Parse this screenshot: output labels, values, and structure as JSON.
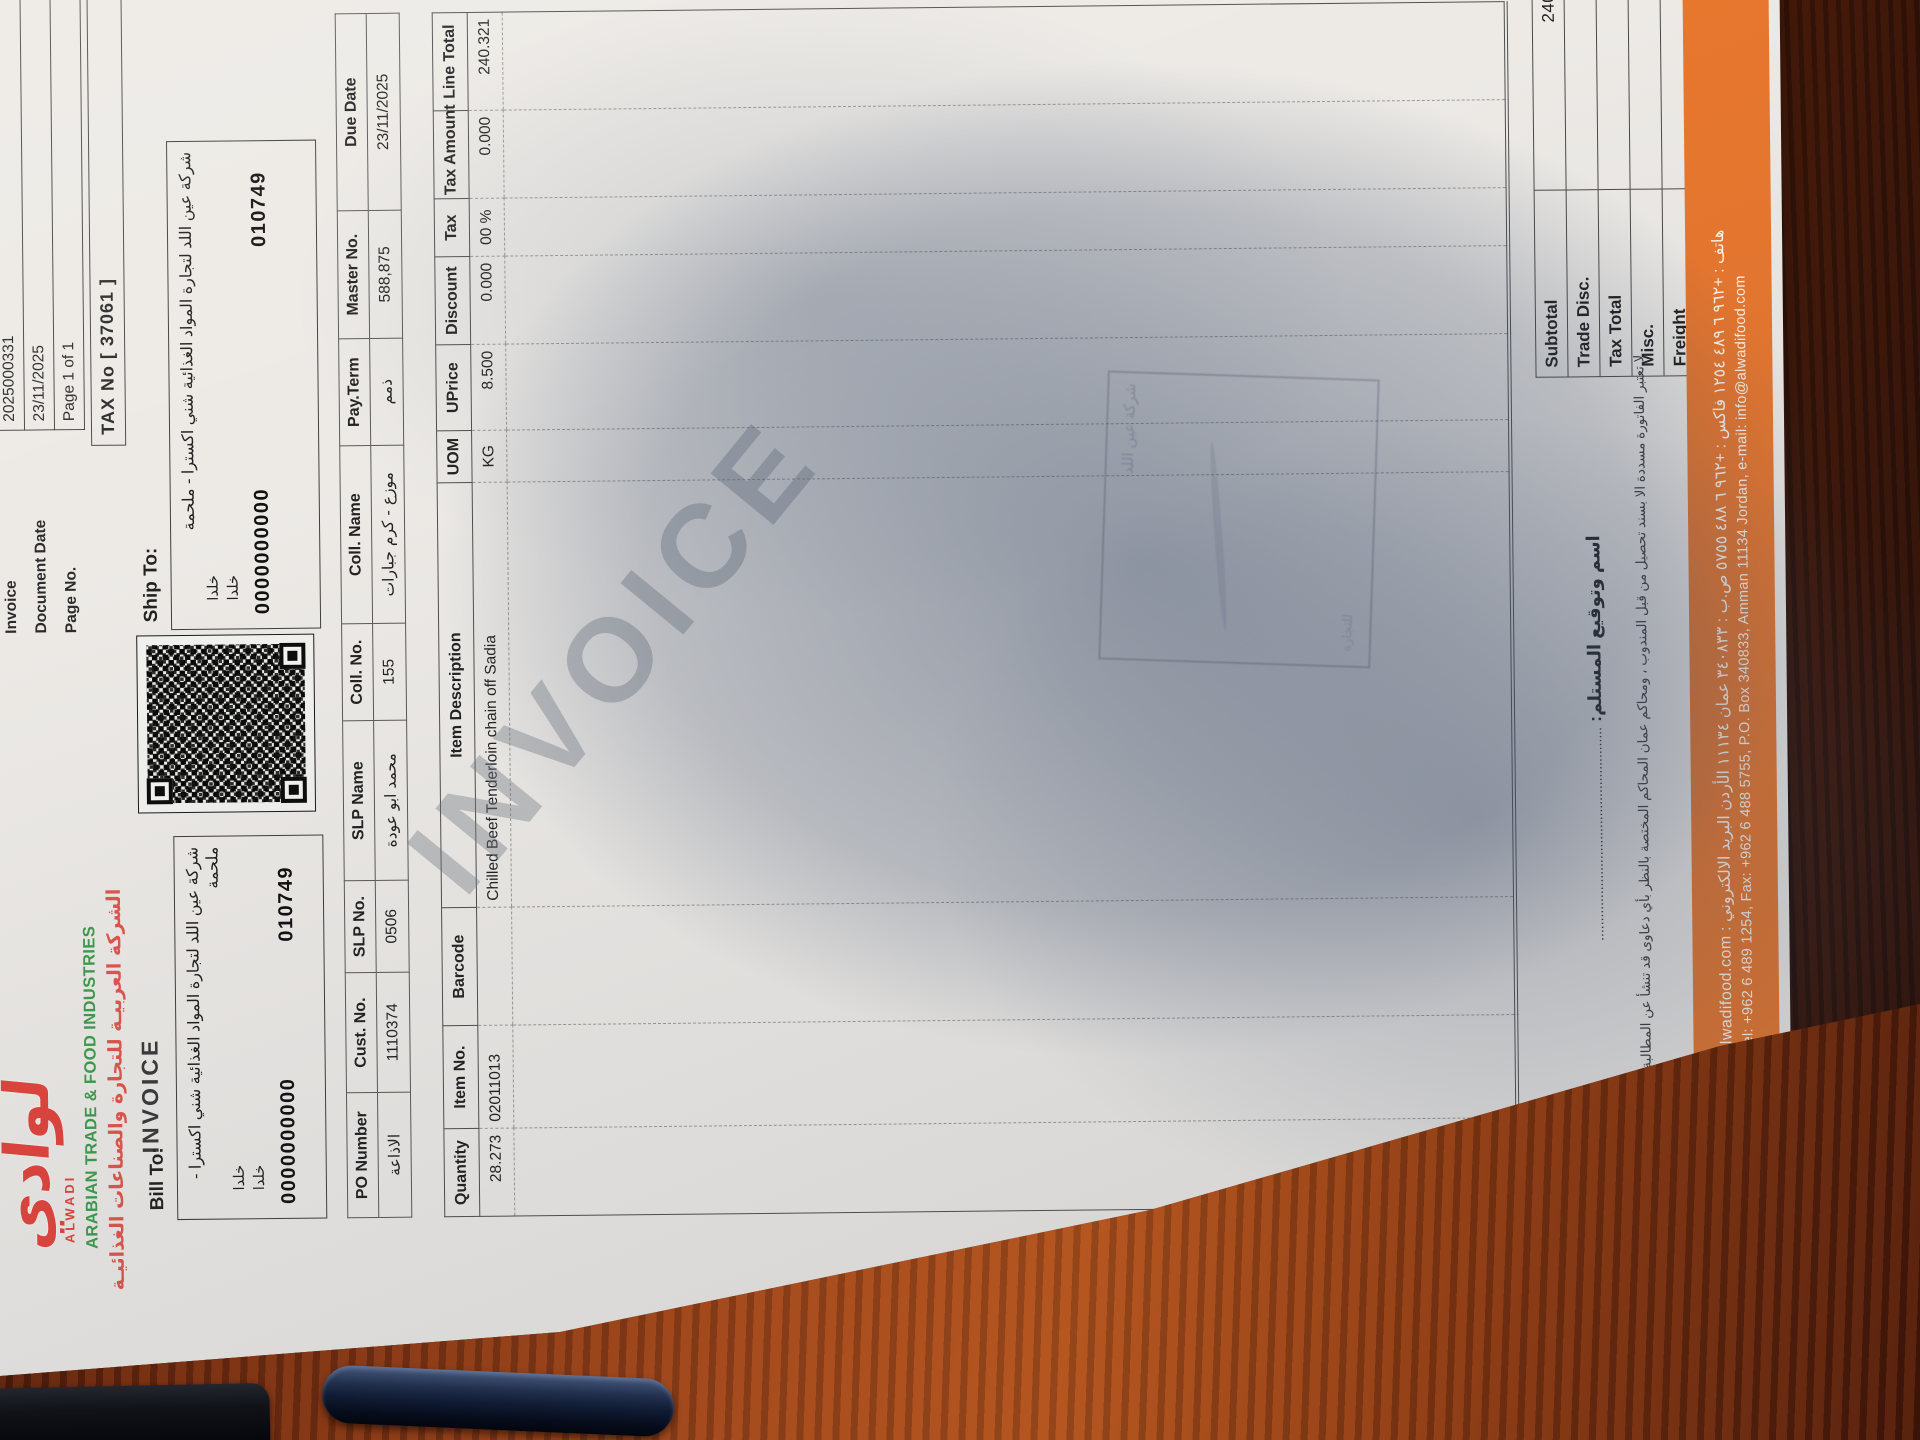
{
  "brand": {
    "logo_arabic": "لوادي",
    "logo_latin": "ALWADI",
    "company_en": "ARABIAN TRADE & FOOD INDUSTRIES",
    "company_ar": "الشركة العربيـة للتجارة والصناعات الغذائيـة",
    "doc_title": "INVOICE"
  },
  "info": {
    "rows": [
      {
        "label": "Invoice",
        "value": "2025000331"
      },
      {
        "label": "Document Date",
        "value": "23/11/2025"
      },
      {
        "label": "Page No.",
        "value": "Page 1 of 1"
      }
    ],
    "tax_no": "TAX No [ 37061 ]"
  },
  "bill_to": {
    "label": "Bill To:",
    "name_ar": "شركة عين اللد لتجارة المواد الغذائية شني اكسترا - ملحمة",
    "addr1": "خلدا",
    "addr2": "خلدا",
    "num1": "0000000000",
    "num2": "010749"
  },
  "ship_to": {
    "label": "Ship To:",
    "name_ar": "شركة عين اللد لتجارة المواد الغذائية شني اكسترا - ملحمة",
    "addr1": "خلدا",
    "addr2": "خلدا",
    "num1": "0000000000",
    "num2": "010749"
  },
  "header_table": {
    "columns": [
      "PO Number",
      "Cust. No.",
      "SLP No.",
      "SLP Name",
      "Coll. No.",
      "Coll. Name",
      "Pay.Term",
      "Master No.",
      "Due Date"
    ],
    "values": [
      "الاذاعة",
      "1110374",
      "0506",
      "محمد ابو عودة",
      "155",
      "موزع - كرم جبارات",
      "ذمم",
      "588,875",
      "23/11/2025"
    ]
  },
  "items_table": {
    "columns": [
      "Quantity",
      "Item No.",
      "Barcode",
      "Item Description",
      "UOM",
      "UPrice",
      "Discount",
      "Tax",
      "Tax Amount",
      "Line Total"
    ],
    "row": {
      "quantity": "28.273",
      "item_no": "02011013",
      "barcode": "",
      "description": "Chilled Beef Tenderloin chain off Sadia",
      "uom": "KG",
      "uprice": "8.500",
      "discount": "0.000",
      "tax": "00 %",
      "tax_amount": "0.000",
      "line_total": "240.321"
    }
  },
  "totals": {
    "subtotal_label": "Subtotal",
    "subtotal": "240.321",
    "trade_disc_label": "Trade Disc.",
    "trade_disc": "",
    "tax_total_label": "Tax Total",
    "tax_total": "",
    "misc_label": "Misc.",
    "misc": "",
    "freight_label": "Freight",
    "freight": "",
    "doc_total_label": "Doc. Total",
    "doc_total": "240.321"
  },
  "signature": {
    "label": "اسم وتوقيع المستلم:",
    "dots": "......................................................."
  },
  "disclaimer": "لا تعتبر الفاتورة مسددة الا بسند تحصيل من قبل المندوب ، ومحاكم عمان المحاكم المختصة بالنظر بأي دعاوى قد تنشأ عن المطالبة بقيمة هذه الفاتورة",
  "watermark": "INVOICE",
  "footer": {
    "line_ar": "هاتف : +٩٦٢ ٦ ٤٨٩ ١٢٥٤   فاكس : +٩٦٢ ٦ ٤٨٨ ٥٧٥٥   ص.ب : ٣٤٠٨٣٣ عمان ١١١٣٤ الأردن   البريد الالكتروني : info@alwadifood.com",
    "line_en": "Tel: +962 6 489 1254, Fax: +962 6 488 5755, P.O. Box 340833, Amman 11134 Jordan, e-mail: info@alwadifood.com"
  },
  "stamp": {
    "text1": "شركة عين اللد",
    "text2": "للتجارة"
  },
  "colors": {
    "accent_orange": "#e8772e",
    "brand_red": "#e2453c",
    "brand_green": "#3e9c4d",
    "paper": "#edeae6",
    "desk_wood": "#6e2a10",
    "shadow_blue": "#3a4a66"
  }
}
